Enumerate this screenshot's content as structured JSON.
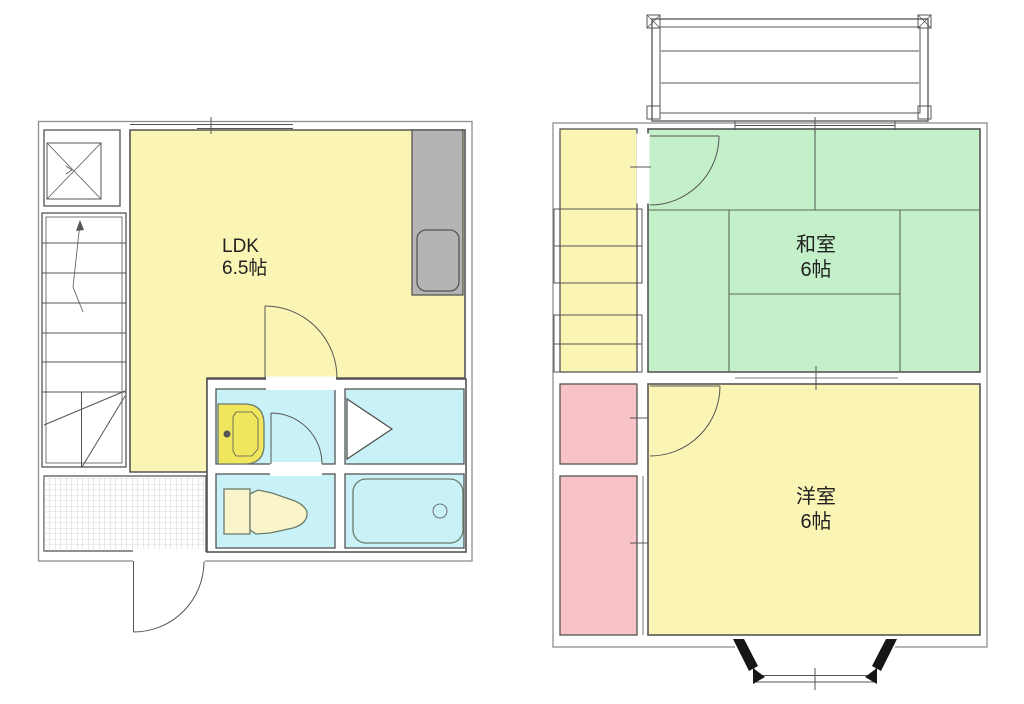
{
  "plan": {
    "floor1": {
      "ldk_name": "LDK",
      "ldk_size": "6.5帖"
    },
    "floor2": {
      "washitsu_name": "和室",
      "washitsu_size": "6帖",
      "yoshitsu_name": "洋室",
      "yoshitsu_size": "6帖"
    }
  },
  "colors": {
    "background": "#FFFFFF",
    "room_yellow": "#FAF5B5",
    "tatami_green": "#C3F0C8",
    "wet_cyan": "#C9F2F8",
    "closet_pink": "#F8C3C6",
    "counter_gray": "#B4B4B4",
    "basin_yellow": "#F0E65E",
    "fixture_cream": "#FAF4CA",
    "wall_line": "#555555"
  },
  "fixtures": {
    "kitchen_sink": "kitchen-sink",
    "washbasin": "washbasin",
    "washing_machine_space": "washing-machine-space",
    "toilet": "toilet",
    "bathtub": "bathtub",
    "staircase": "staircase",
    "balcony": "balcony",
    "bay_window": "bay-window",
    "entrance_door": "entrance-door"
  }
}
